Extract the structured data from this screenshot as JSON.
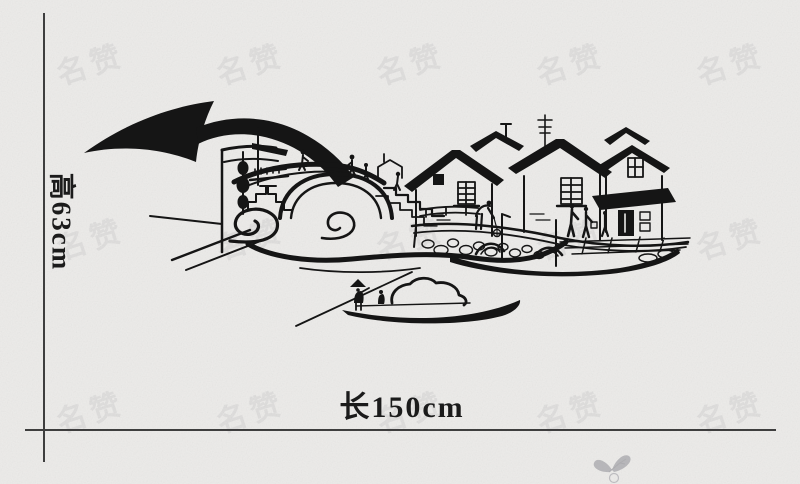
{
  "product_image": {
    "background_color": "#ecebe9",
    "ink_color": "#151515",
    "axis_color": "#3e3e3e",
    "height_label": "高63cm",
    "length_label": "长150cm",
    "watermark_text": "名赞",
    "watermark_color": "rgba(108,108,120,0.10)",
    "artwork_name": "jiangnan-water-town-silhouette-wall-decal",
    "artwork_elements": [
      "curved-eave-roofs",
      "hanging-lanterns",
      "stone-arch-bridge",
      "bridge-pedestrians",
      "stone-staircases",
      "water-swirls",
      "riverside-houses",
      "lattice-windows",
      "tv-antenna",
      "door-awning",
      "stone-quay",
      "moored-canopy-boat",
      "dock-figures",
      "sampan-boat",
      "boatman-with-pole",
      "butterfly-mark"
    ]
  }
}
